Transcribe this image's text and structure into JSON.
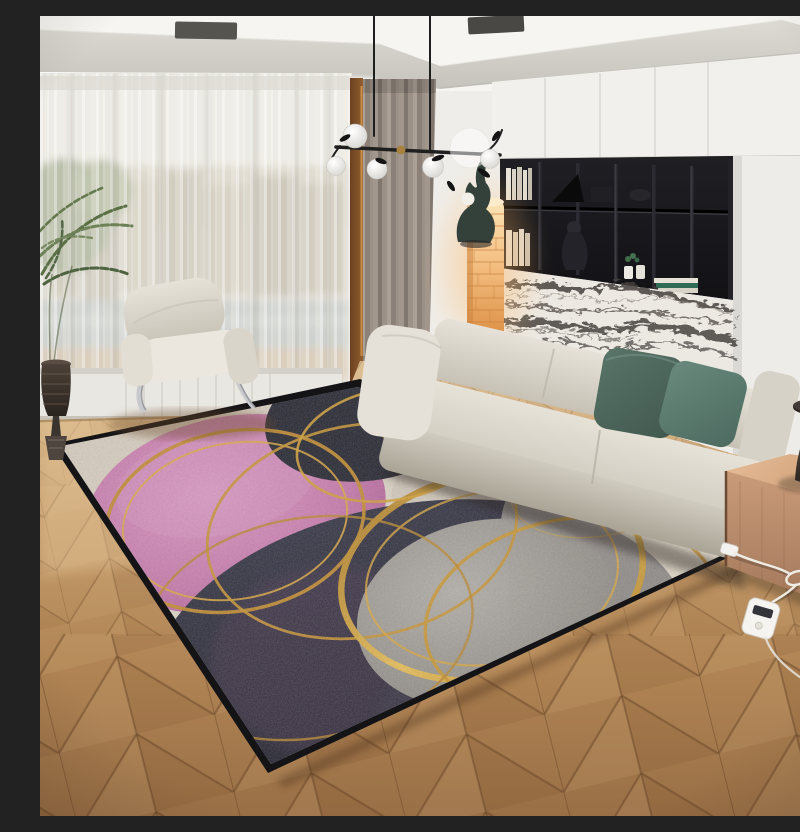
{
  "scene": {
    "type": "interior-product-photo",
    "title": "Modern living room with abstract pink, navy, grey and gold-circle area rug",
    "description": "Photorealistic living room: sheer-curtained window with city view, taupe drape, black pendant chandelier with glass globes, white armchair with chrome legs, palm plant in dark pot, black wall shelving over a marble panel, glowing amber column lamp with hare sculpture, cream modular sofa with two teal pillows, wooden cube side table with dark hourglass lamp, chevron oak floor, and a large abstract rug with overlapping pink, navy and grey circles outlined by gold rings, with a white heater cord and remote on the floor.",
    "objects": [
      "ceiling with recessed soffit and LED cove",
      "ceiling vents",
      "pendant chandelier with frosted globes and leaf ornaments",
      "sheer curtain over city-view window",
      "taupe drape",
      "white lounge armchair with chrome legs",
      "palm plant in dark ridged pot",
      "white upper cabinets",
      "black open shelving with books and figurines",
      "black-and-white marble panel",
      "glowing amber brick column lamp",
      "dark hare sculpture with white sphere",
      "cream modular sofa",
      "two teal green pillows",
      "wooden cube side table",
      "dark hourglass table lamp with glowing neck",
      "abstract area rug with gold circles",
      "white power cord, loop, plug and remote control",
      "chevron parquet wood floor"
    ],
    "palette": {
      "ceiling_white": "#f6f5f2",
      "soffit_grey": "#d3d0ca",
      "wall_white": "#efede9",
      "sheer": "#f4f2ec",
      "drape_taupe": "#978d83",
      "wood_frame": "#7d4f29",
      "shelf_black": "#17171a",
      "marble_white": "#ece8e2",
      "marble_vein": "#45413d",
      "column_amber": "#f2b56f",
      "sofa_cream": "#dcd7cc",
      "pillow_teal_dark": "#4e6a61",
      "pillow_teal": "#5d7d72",
      "armchair_white": "#eeebe4",
      "chrome": "#c8c9cc",
      "box_wood": "#c89a78",
      "lamp_dark": "#3a302b",
      "lamp_glow": "#fff3dc",
      "floor_wood_light": "#ddbf93",
      "floor_wood_dark": "#996f46",
      "rug_base_beige": "#d3c9bb",
      "rug_pink": "#c47aab",
      "rug_navy": "#23242f",
      "rug_grey": "#9a958f",
      "rug_cream": "#e2dacb",
      "rug_gold": "#d9a441",
      "rug_border_black": "#141417",
      "cord_white": "#efece6"
    }
  }
}
